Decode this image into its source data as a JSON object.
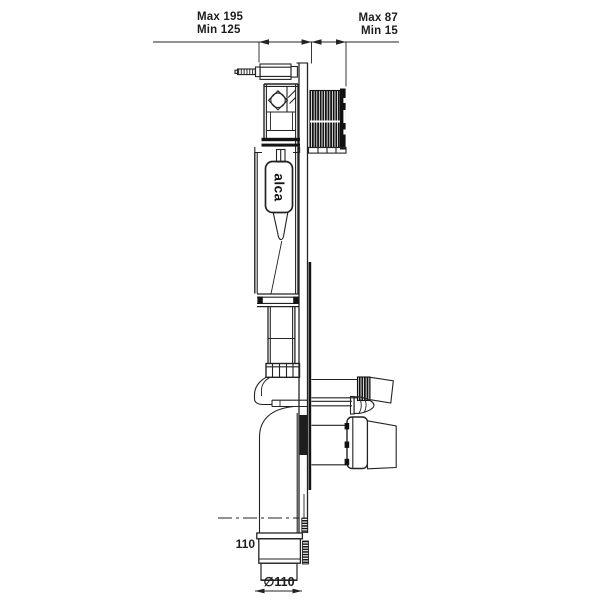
{
  "labels": {
    "top_left": {
      "max": "Max 195",
      "min": "Min 125"
    },
    "top_right": {
      "max": "Max 87",
      "min": "Min 15"
    },
    "pipe_width": "110",
    "pipe_diameter": "∅110",
    "brand": "alca"
  },
  "colors": {
    "line": "#232323",
    "fill_dark": "#141414",
    "background": "#ffffff",
    "text": "#1d1d1d"
  }
}
